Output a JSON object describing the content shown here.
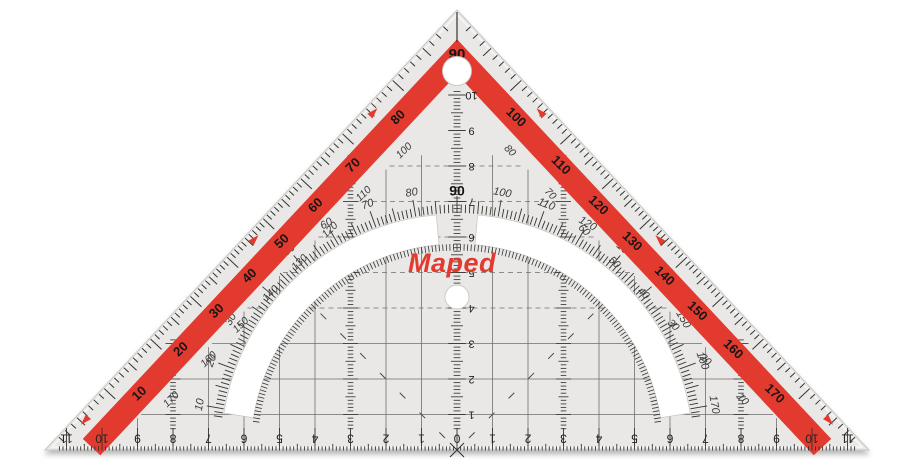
{
  "brand": {
    "name": "Maped"
  },
  "colors": {
    "red": "#e23a2e",
    "body": "#e9e8e6",
    "edge": "#c6c6c3",
    "highlight": "#fafaf9",
    "tick": "#333330",
    "grid": "#6e6e6c",
    "label": "#161616",
    "secondary": "#3a3a38",
    "background": "#ffffff"
  },
  "protractor": {
    "outer_scale_labels": [
      "10",
      "20",
      "30",
      "40",
      "50",
      "60",
      "70",
      "80",
      "90",
      "100",
      "110",
      "120",
      "130",
      "140",
      "150",
      "160",
      "170"
    ],
    "reverse_scale_labels": [
      "170",
      "160",
      "150",
      "140",
      "130",
      "120",
      "110",
      "100",
      "80",
      "70",
      "60",
      "50",
      "40",
      "30",
      "20",
      "10"
    ],
    "arc_scale_labels": [
      "10",
      "20",
      "30",
      "40",
      "50",
      "60",
      "70",
      "80",
      "90",
      "100",
      "110",
      "120",
      "130",
      "140",
      "150",
      "160",
      "170"
    ]
  },
  "bottom_ruler": {
    "left_labels": [
      "11",
      "10",
      "9",
      "8",
      "7",
      "6",
      "5",
      "4",
      "3",
      "2",
      "1"
    ],
    "zero_label": "0",
    "right_labels": [
      "1",
      "2",
      "3",
      "4",
      "5",
      "6",
      "7",
      "8",
      "9",
      "10",
      "11"
    ]
  },
  "center_ruler": {
    "labels": [
      "1",
      "2",
      "3",
      "4",
      "5",
      "6",
      "7",
      "8",
      "9",
      "10"
    ]
  }
}
